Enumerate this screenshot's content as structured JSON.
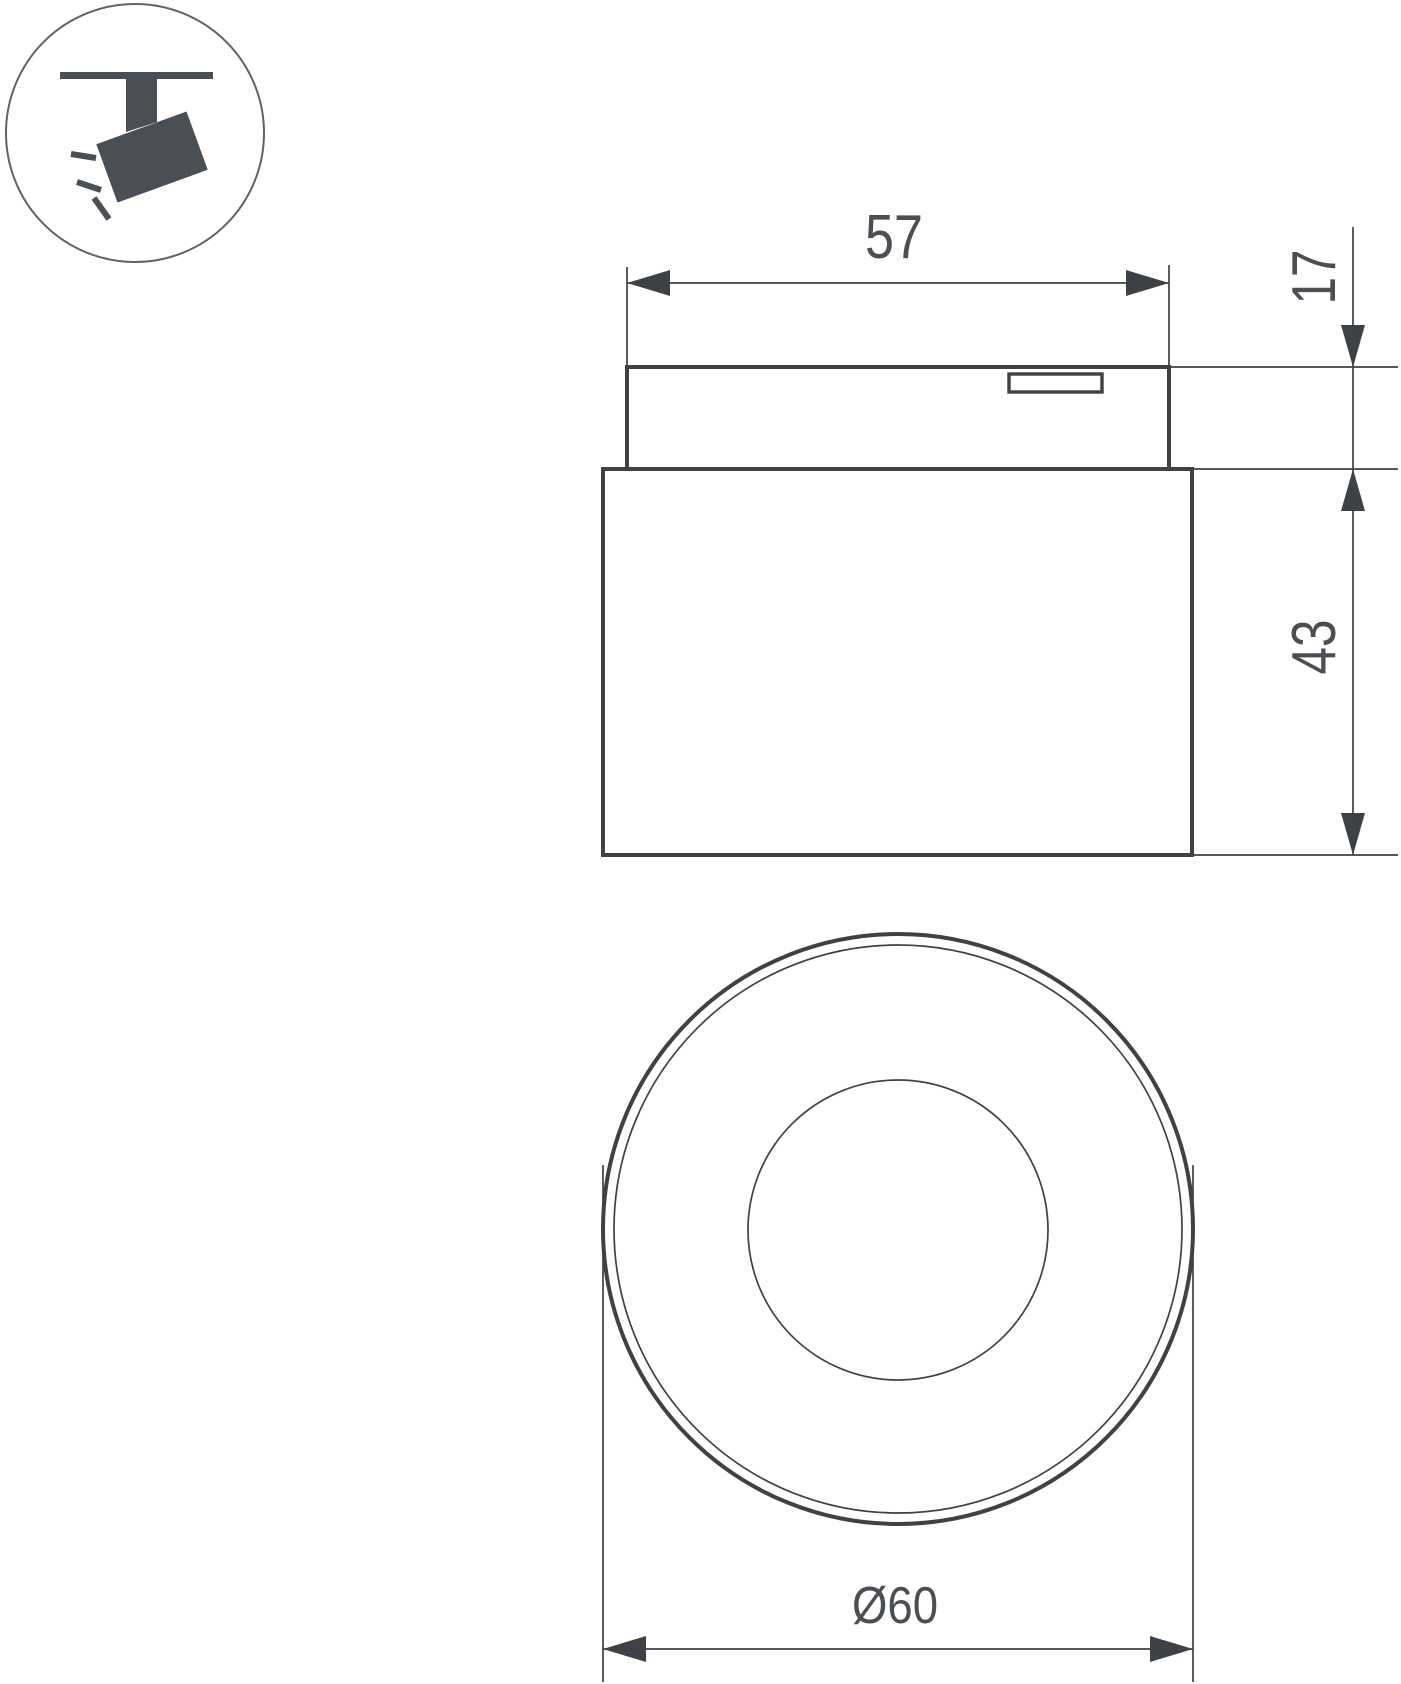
{
  "colors": {
    "background": "#ffffff",
    "line": "#3e4145",
    "text": "#4b4f54",
    "icon": "#4a4f55"
  },
  "icons": {
    "badge": "track-spotlight-icon"
  },
  "dimensions": {
    "top_width": "57",
    "mount_height": "17",
    "body_height": "43",
    "outer_diameter": "Ø60"
  }
}
